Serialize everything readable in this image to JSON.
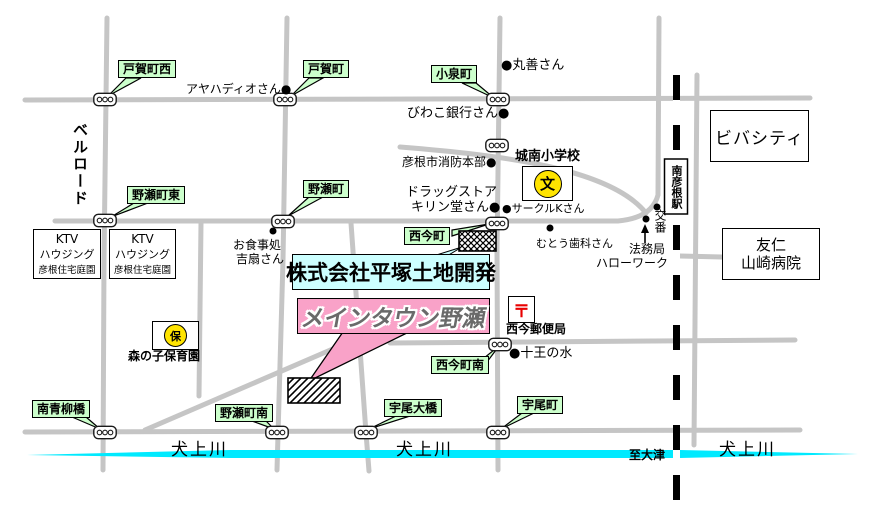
{
  "colors": {
    "road": "#c5c5c5",
    "river": "#00eaff",
    "green_label_bg": "#ccffcc",
    "company_bg": "#ccffff",
    "maintown_bg": "#f9a2c8",
    "symbol_yellow": "#ffe400",
    "post_red": "#e80000",
    "railway": "#000000"
  },
  "green_labels": [
    "戸賀町西",
    "戸賀町",
    "小泉町",
    "野瀬町東",
    "野瀬町",
    "西今町",
    "西今町南",
    "南青柳橋",
    "野瀬町南",
    "宇尾大橋",
    "宇尾町"
  ],
  "places": {
    "viva_city": "ビバシティ",
    "hospital_line1": "友仁",
    "hospital_line2": "山崎病院",
    "ktv_line1": "KTV",
    "ktv_line2": "ハウジング",
    "ktv_line3": "彦根住宅庭園",
    "station": "南彦根駅",
    "school_name": "城南小学校",
    "school_symbol": "文",
    "nursery_symbol": "保",
    "nursery_name": "森の子保育園",
    "post_symbol": "〒",
    "post_office": "西今郵便局",
    "company": "株式会社平塚土地開発",
    "main_town": "メインタウン野瀬"
  },
  "annotations": {
    "ayahadio": "アヤハディオさん●",
    "maruzen": "●丸善さん",
    "biwako_bank": "びわこ銀行さん●",
    "fire_dept": "彦根市消防本部●",
    "drugstore_line1": "ドラッグストア",
    "drugstore_line2": "キリン堂さん●",
    "circle_k": "●サークルKさん",
    "muto_dental": "むとう歯科さん",
    "koban": "交番",
    "homukyoku": "法務局",
    "hello_work": "ハローワーク",
    "restaurant_line1": "お食事処",
    "restaurant_line2": "吉扇さん",
    "juo_water": "●十王の水",
    "bell_road": "ベルロード",
    "river_name": "犬上川",
    "to_otsu": "至大津"
  }
}
